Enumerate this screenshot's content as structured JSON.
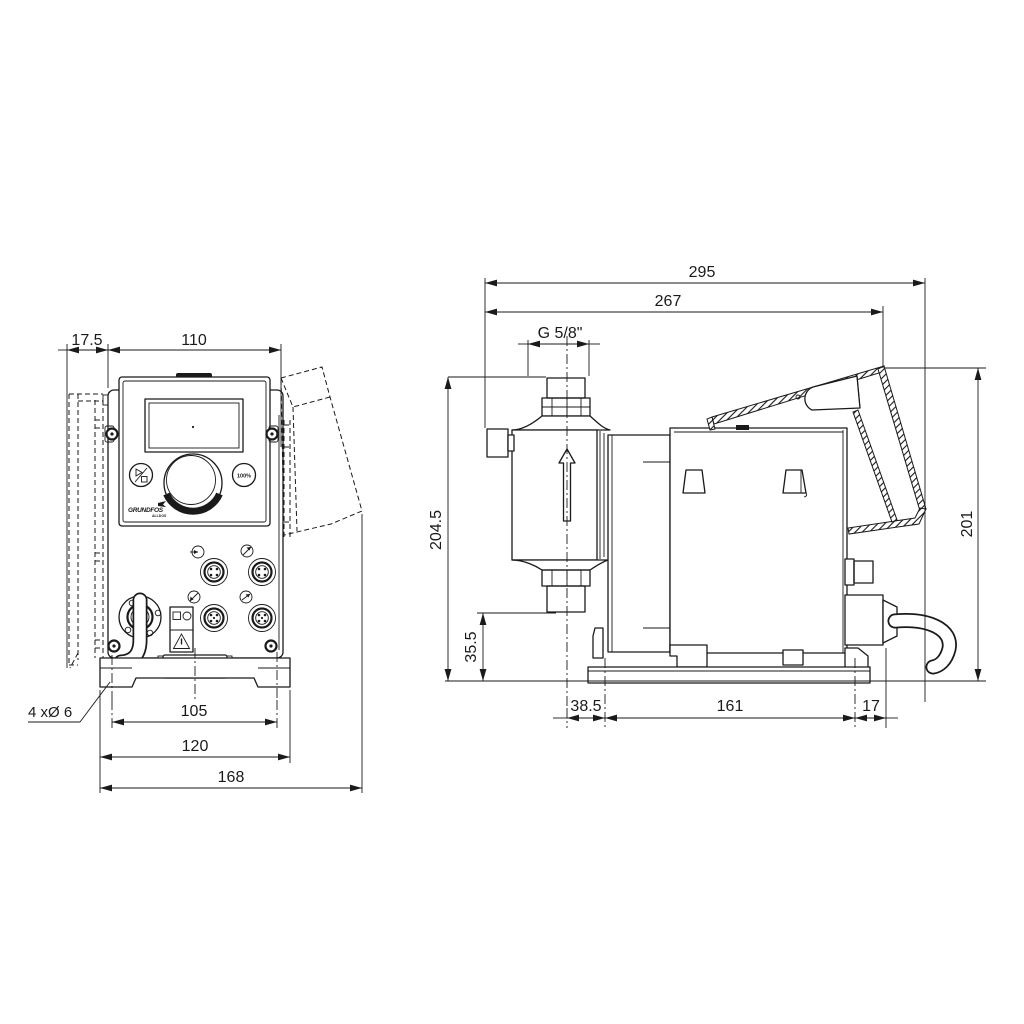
{
  "title": "Dosing pump dimensional drawing, front and side view",
  "colors": {
    "line": "#1a1a1a",
    "background": "#ffffff"
  },
  "front": {
    "dims": {
      "wall_offset": "17.5",
      "body_width": "110",
      "hole_spacing": "105",
      "plate_width": "120",
      "overall_width": "168",
      "holes_note": "4 xØ 6"
    },
    "panel": {
      "max_button": "100%",
      "logo": "GRUNDFOS",
      "logo_sub": "ALLDOS"
    },
    "icons": {
      "run_stop_button": "play-slash-stop",
      "warning_label": "triangle-exclamation",
      "connector_sockets": "m12-socket",
      "connector_tags": "plug-arrow"
    }
  },
  "side": {
    "dims": {
      "overall_length": "295",
      "hood_length": "267",
      "thread": "G 5/8\"",
      "height_total": "204.5",
      "fitting_height": "35.5",
      "hood_height": "201",
      "head_offset": "38.5",
      "base_length": "161",
      "rear_offset": "17"
    },
    "icons": {
      "flow_direction": "up-arrow"
    }
  }
}
